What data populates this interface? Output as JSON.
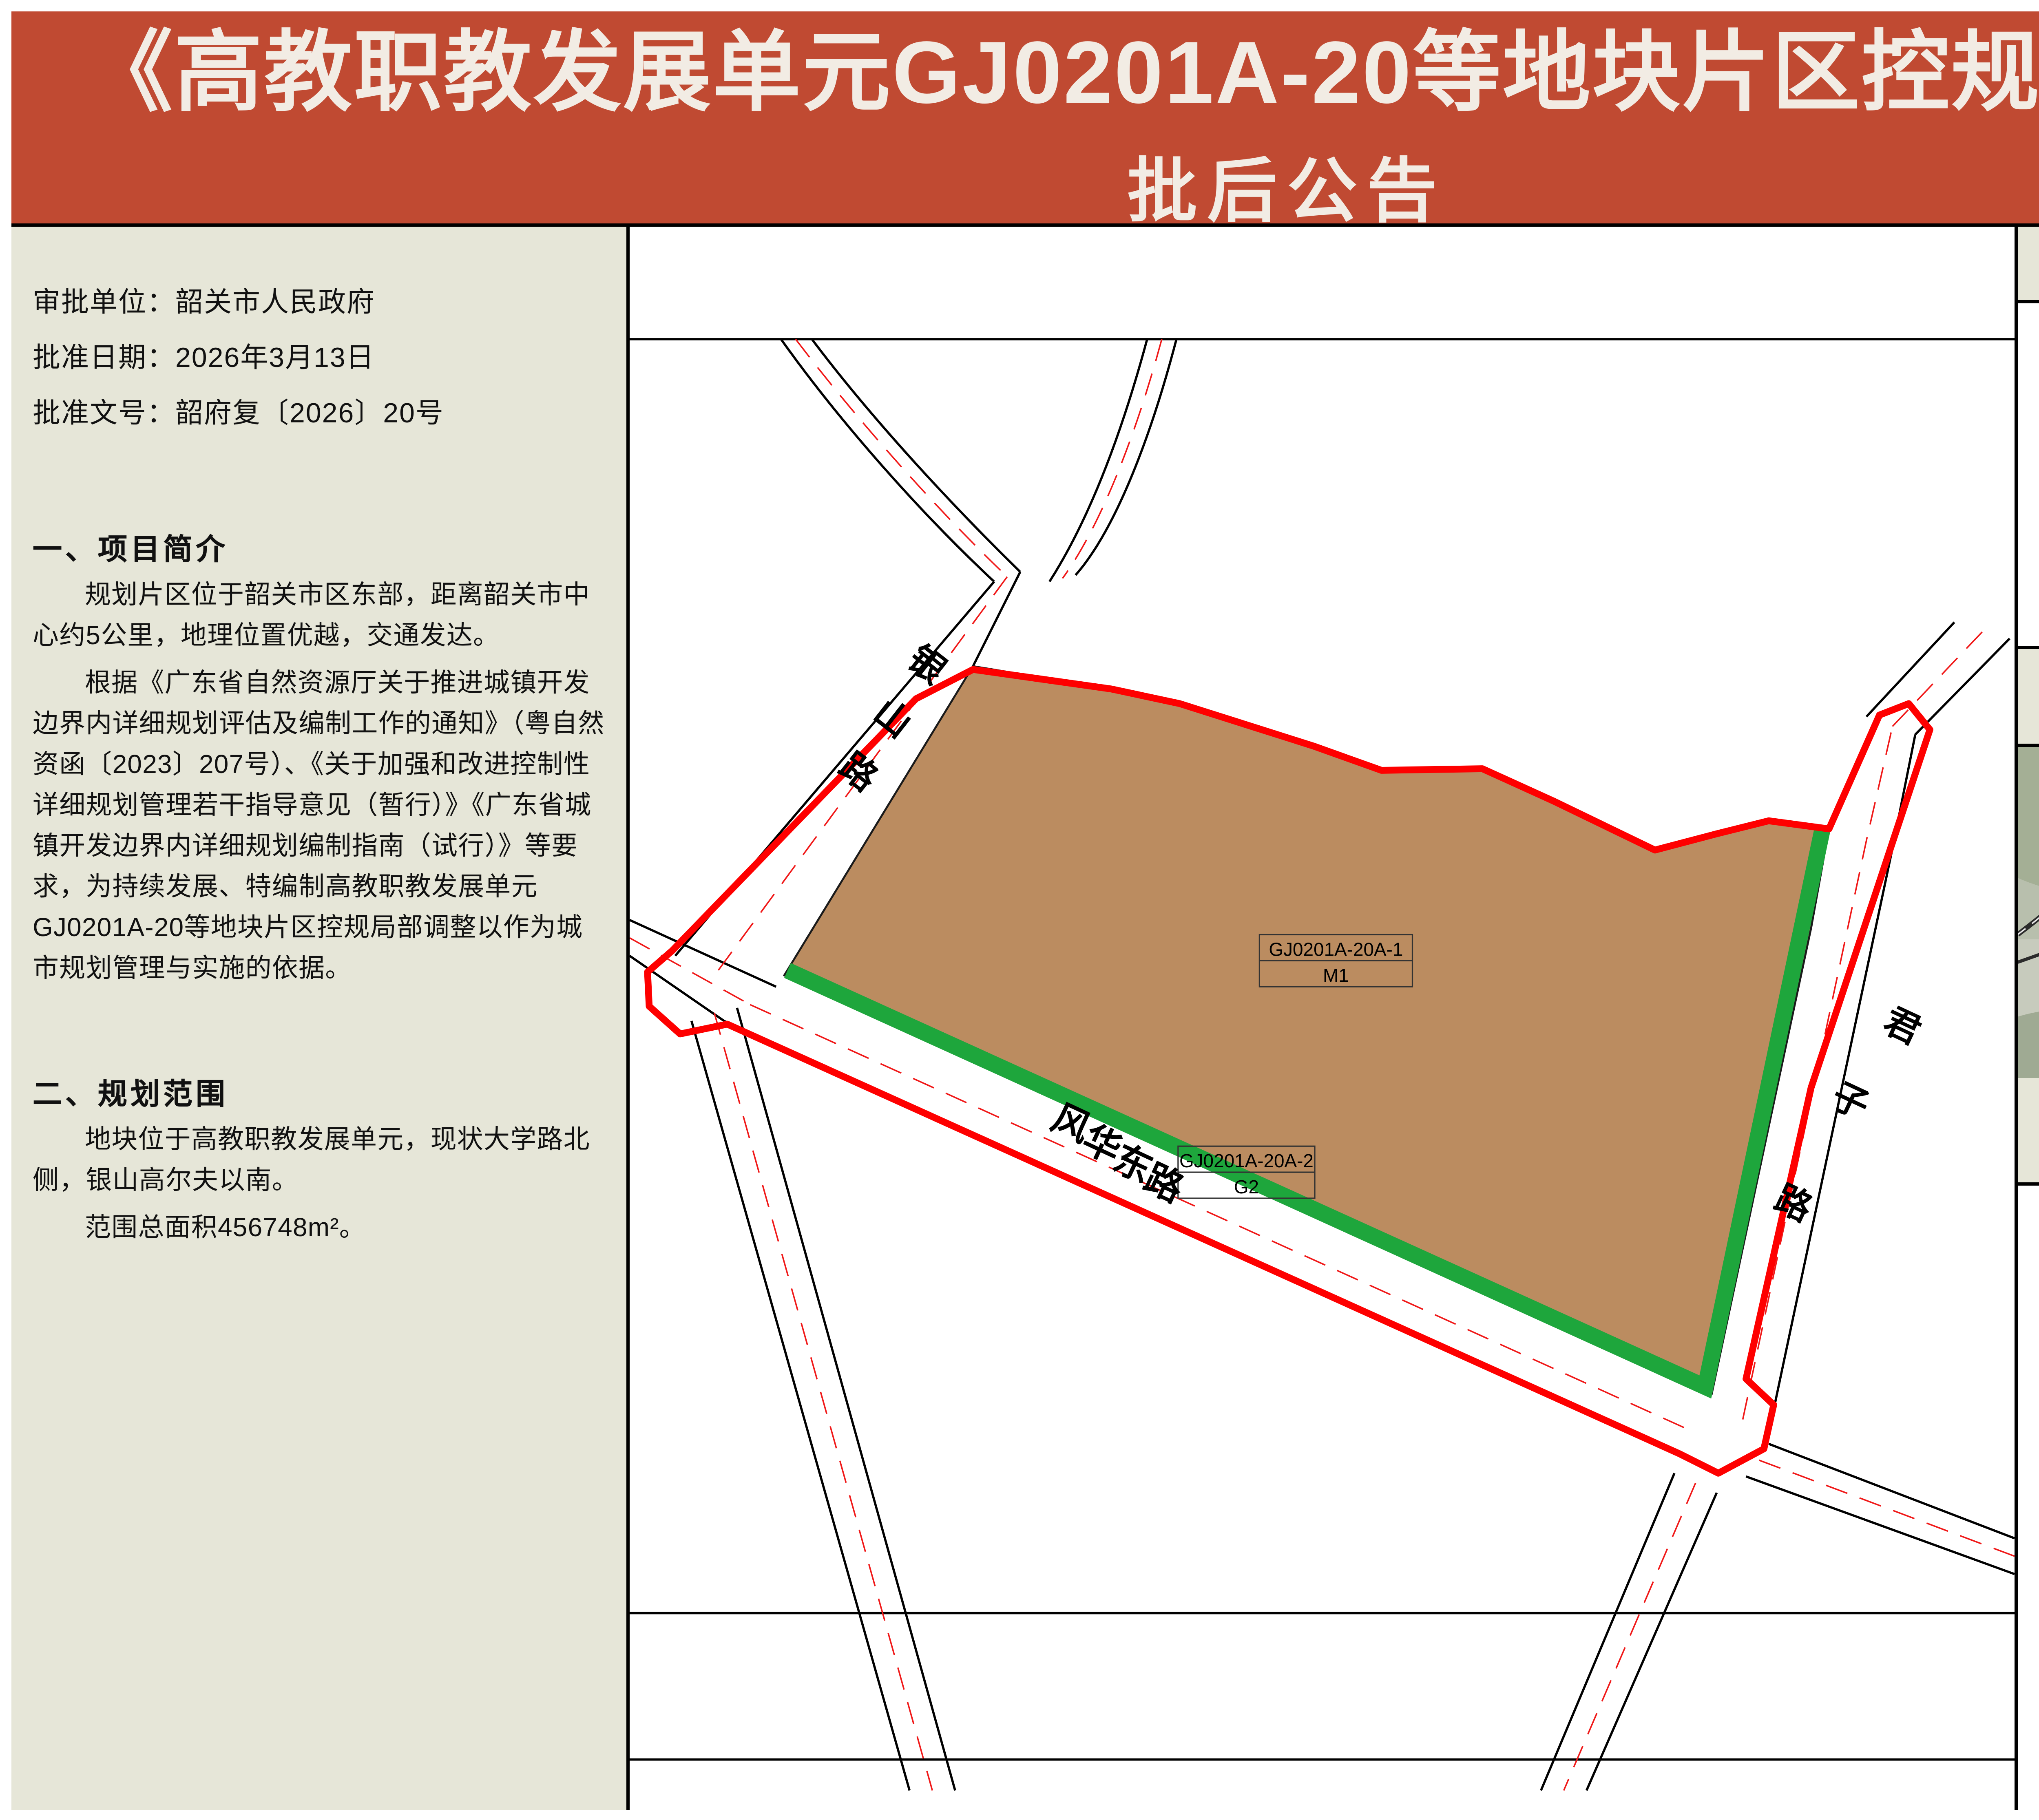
{
  "banner": {
    "title_line1": "《高教职教发展单元GJ0201A-20等地块片区控规局部调整》",
    "title_line2": "批后公告",
    "bg_color": "#C04A32"
  },
  "info": {
    "lines": [
      "审批单位：韶关市人民政府",
      "批准日期：2026年3月13日",
      "批准文号：韶府复〔2026〕20号"
    ]
  },
  "sections": [
    {
      "heading": "一、项目简介",
      "paragraphs": [
        "规划片区位于韶关市区东部，距离韶关市中心约5公里，地理位置优越，交通发达。",
        "根据《广东省自然资源厅关于推进城镇开发边界内详细规划评估及编制工作的通知》（粤自然资函〔2023〕207号）、《关于加强和改进控制性详细规划管理若干指导意见（暂行）》《广东省城镇开发边界内详细规划编制指南（试行）》等要求，为持续发展、特编制高教职教发展单元GJ0201A-20等地块片区控规局部调整以作为城市规划管理与实施的依据。"
      ]
    },
    {
      "heading": "二、规划范围",
      "paragraphs": [
        "地块位于高教职教发展单元，现状大学路北侧，银山高尔夫以南。",
        "范围总面积456748m²。"
      ]
    }
  ],
  "map": {
    "boundary_color": "#FE0000",
    "parcels": [
      {
        "code": "GJ0201A-20A-1",
        "use_code": "M1",
        "color": "#BB8C60"
      },
      {
        "code": "GJ0201A-20A-2",
        "use_code": "G2",
        "color": "#1EA63C"
      }
    ],
    "roads": [
      {
        "name": "银山路",
        "chars": [
          "银",
          "山",
          "路"
        ]
      },
      {
        "name": "风华东路",
        "chars": [
          "风",
          "华",
          "东",
          "路"
        ]
      },
      {
        "name": "君子路",
        "chars": [
          "君",
          "子",
          "路"
        ]
      }
    ]
  },
  "wind_rose": {
    "title": "风玫瑰",
    "north_label": "N"
  },
  "location": {
    "title": "区位示意图",
    "project_label": "项目位置",
    "pois": [
      {
        "name": "银山"
      },
      {
        "name": "韶关市浈江中等职业学校"
      },
      {
        "name": "韶关学院"
      }
    ],
    "roads": [
      {
        "label": "南韶高速"
      },
      {
        "label": "银山路"
      },
      {
        "label": "风华东路"
      },
      {
        "label": "大学路"
      }
    ],
    "highlight_color": "#CC1F1F"
  },
  "legend": {
    "title": "图例",
    "items": [
      {
        "label": "一类工业用地",
        "color": "#C49A76"
      },
      {
        "label": "防护绿地",
        "color": "#17A055"
      }
    ]
  }
}
